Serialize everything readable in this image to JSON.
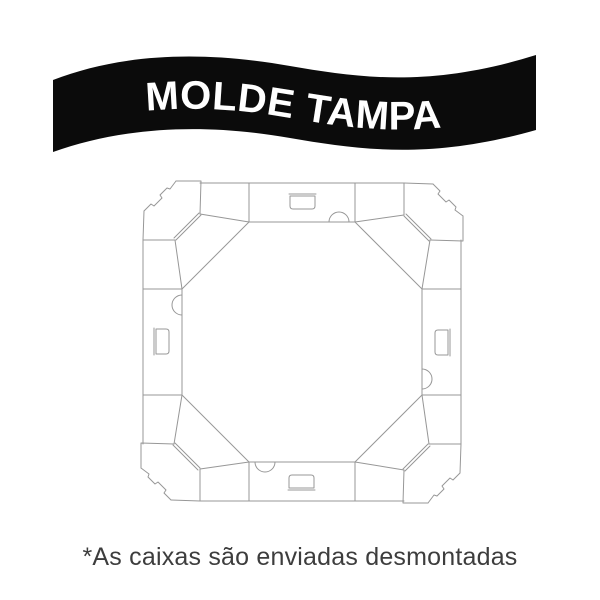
{
  "banner": {
    "title": "MOLDE TAMPA",
    "background_color": "#0b0b0b",
    "text_color": "#ffffff"
  },
  "diagram": {
    "line_color": "#979797"
  },
  "footnote": {
    "text": "*As caixas são enviadas desmontadas",
    "color": "#3d3d3d"
  }
}
